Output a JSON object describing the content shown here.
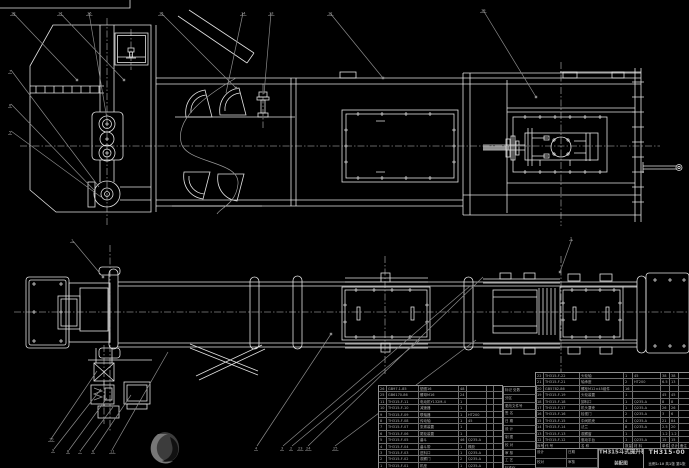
{
  "drawing": {
    "title_line1": "TH315斗式提升机",
    "title_line2": "装配图",
    "drawing_no": "TH315-00",
    "info_row": "比例1:10 共1张 第1张",
    "watermark_icon": "swirl-stamp",
    "colors": {
      "background": "#000000",
      "linework": "#e2e2e2",
      "leader_lines": "#8a8a8a",
      "table_text": "#b2b2b2"
    }
  },
  "balloons": [
    {
      "x": 10,
      "y": 8,
      "n": "18"
    },
    {
      "x": 57,
      "y": 8,
      "n": "17"
    },
    {
      "x": 86,
      "y": 8,
      "n": "16"
    },
    {
      "x": 158,
      "y": 8,
      "n": "15"
    },
    {
      "x": 240,
      "y": 8,
      "n": "14"
    },
    {
      "x": 268,
      "y": 8,
      "n": "13"
    },
    {
      "x": 327,
      "y": 8,
      "n": "12"
    },
    {
      "x": 480,
      "y": 5,
      "n": "19"
    },
    {
      "x": 8,
      "y": 66,
      "n": "7"
    },
    {
      "x": 8,
      "y": 100,
      "n": "6"
    },
    {
      "x": 8,
      "y": 127,
      "n": "5"
    },
    {
      "x": 70,
      "y": 235,
      "n": "1"
    },
    {
      "x": 569,
      "y": 233,
      "n": "2"
    },
    {
      "x": 48,
      "y": 434,
      "n": "10"
    },
    {
      "x": 51,
      "y": 445,
      "n": "9"
    },
    {
      "x": 66,
      "y": 446,
      "n": "8"
    },
    {
      "x": 78,
      "y": 446,
      "n": "7"
    },
    {
      "x": 91,
      "y": 446,
      "n": "6"
    },
    {
      "x": 109,
      "y": 446,
      "n": "11"
    },
    {
      "x": 254,
      "y": 443,
      "n": "4"
    },
    {
      "x": 280,
      "y": 443,
      "n": "3"
    },
    {
      "x": 289,
      "y": 443,
      "n": "2"
    },
    {
      "x": 297,
      "y": 443,
      "n": "23"
    },
    {
      "x": 305,
      "y": 443,
      "n": "24"
    },
    {
      "x": 332,
      "y": 443,
      "n": "25"
    }
  ],
  "bom_left": {
    "rows": [
      [
        "26",
        "GB97.1-85",
        "垫圈16",
        "48",
        "",
        "",
        ""
      ],
      [
        "25",
        "GB6170-86",
        "螺母M16",
        "24",
        "",
        "",
        ""
      ],
      [
        "11",
        "TH315-F-11",
        "电动机Y132M-4",
        "1",
        "",
        "",
        ""
      ],
      [
        "10",
        "TH315-F-10",
        "减速器",
        "1",
        "",
        "",
        ""
      ],
      [
        "9",
        "TH315-F-09",
        "联轴器",
        "1",
        "HT200",
        "",
        ""
      ],
      [
        "8",
        "TH315-F-08",
        "传动轴",
        "1",
        "45",
        "",
        ""
      ],
      [
        "7",
        "TH315-F-07",
        "张紧装置",
        "1",
        "",
        "",
        ""
      ],
      [
        "6",
        "TH315-F-06",
        "尾轮装置",
        "1",
        "",
        "",
        ""
      ],
      [
        "5",
        "TH315-F-05",
        "畚斗",
        "46",
        "Q235-A",
        "",
        ""
      ],
      [
        "4",
        "TH315-F-04",
        "畚斗带",
        "1",
        "橡胶",
        "",
        ""
      ],
      [
        "3",
        "TH315-F-03",
        "进料口",
        "1",
        "Q235-A",
        "",
        ""
      ],
      [
        "2",
        "TH315-F-02",
        "观察门",
        "2",
        "Q235-A",
        "",
        ""
      ],
      [
        "1",
        "TH315-F-01",
        "机座",
        "1",
        "Q235-A",
        "",
        ""
      ]
    ]
  },
  "bom_right": {
    "rows": [
      [
        "22",
        "TH315-F-22",
        "头轮轴",
        "1",
        "45",
        "38",
        "38",
        ""
      ],
      [
        "21",
        "TH315-F-21",
        "轴承座",
        "2",
        "HT200",
        "6.5",
        "13",
        ""
      ],
      [
        "20",
        "GB5782-86",
        "螺栓M12×45组件",
        "16",
        "",
        "",
        "",
        ""
      ],
      [
        "19",
        "TH315-F-19",
        "头轮装置",
        "1",
        "",
        "45",
        "45",
        ""
      ],
      [
        "18",
        "TH315-F-18",
        "卸料口",
        "1",
        "Q235-A",
        "8",
        "8",
        ""
      ],
      [
        "17",
        "TH315-F-17",
        "机头罩壳",
        "1",
        "Q235-A",
        "26",
        "26",
        ""
      ],
      [
        "16",
        "TH315-F-16",
        "检视门",
        "2",
        "Q235-A",
        "3",
        "6",
        ""
      ],
      [
        "15",
        "TH315-F-15",
        "中间机壳",
        "4",
        "Q235-A",
        "21",
        "84",
        ""
      ],
      [
        "14",
        "TH315-F-14",
        "法兰",
        "8",
        "Q235-A",
        "2.5",
        "20",
        ""
      ],
      [
        "13",
        "TH315-F-13",
        "观察窗",
        "1",
        "",
        "1.2",
        "1.2",
        ""
      ],
      [
        "12",
        "TH315-F-12",
        "驱动平台",
        "1",
        "Q235-A",
        "15",
        "15",
        ""
      ],
      [
        "序号",
        "代  号",
        "名  称",
        "数量",
        "材  料",
        "单件",
        "总计",
        "备注"
      ]
    ]
  },
  "rev_block": {
    "rows": [
      "标记 处数",
      "分区",
      "更改文件号",
      "签 名",
      "日 期",
      "设 计",
      "制 图",
      "校 对",
      "审 核",
      "工 艺",
      "标准化",
      "批 准"
    ]
  },
  "sig_block": {
    "cells": [
      "设计",
      "日期",
      "校对",
      "审核"
    ]
  }
}
